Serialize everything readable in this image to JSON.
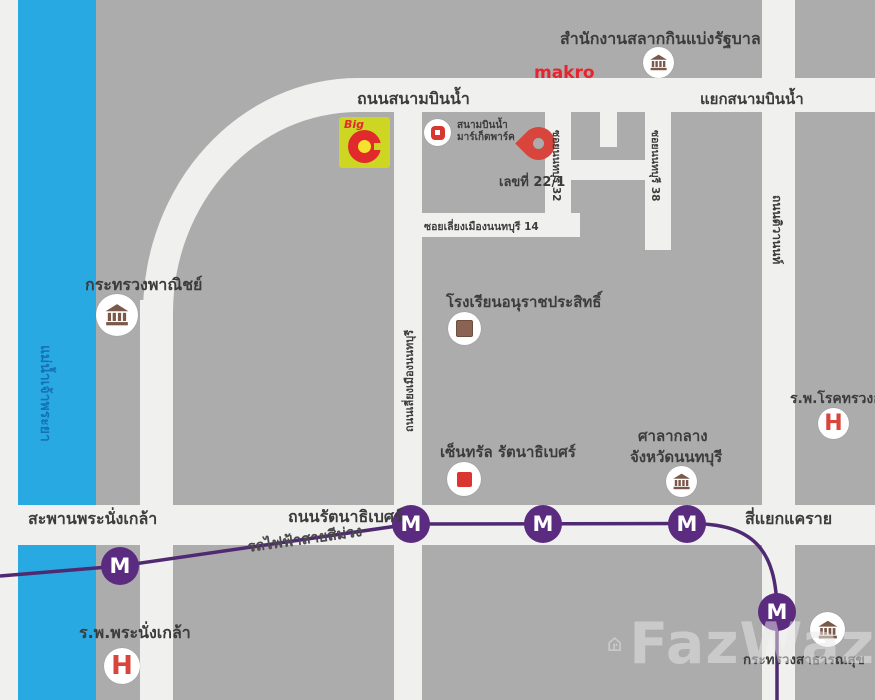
{
  "colors": {
    "block_gray": "#acacac",
    "road_white": "#f0f0ee",
    "river_blue": "#29a9e1",
    "river_text_blue": "#1573b5",
    "purple_line": "#4f2a72",
    "station_purple": "#5b2b80",
    "pin_red": "#d8453c",
    "makro_red": "#e8232d",
    "bigc_red": "#e02a2b",
    "bigc_yellow": "#cdd622",
    "icon_brown": "#7a594a",
    "label_text": "#3c3c3c"
  },
  "river": {
    "name": "แม่น้ำเจ้าพระยา"
  },
  "roads": {
    "sanambinnam": "ถนนสนามบินน้ำ",
    "sanambinnam_junction": "แยกสนามบินน้ำ",
    "liang_mueang": "ถนนเลี่ยงเมืองนนทบุรี",
    "soi_32": "ซอยนนทบุรี 32",
    "soi_38": "ซอยนนทบุรี 38",
    "soi_14": "ซอยเลี่ยงเมืองนนทบุรี 14",
    "rattanathibet": "ถนนรัตนาธิเบศร์",
    "tiwanon": "ถนนติวานนท์",
    "khae_rai_junction": "สี่แยกแคราย",
    "bridge": "สะพานพระนั่งเกล้า"
  },
  "transit": {
    "line_label": "รถไฟฟ้าสายสีม่วง",
    "station_letter": "M"
  },
  "places": {
    "lottery_office": "สำนักงานสลากกินแบ่งรัฐบาล",
    "makro": "makro",
    "bigc_word": "Big",
    "market_park_line1": "สนามบินน้ำ",
    "market_park_line2": "มาร์เก็ตพาร์ค",
    "pin_label": "เลขที่ 22/1",
    "commerce_ministry": "กระทรวงพาณิชย์",
    "school": "โรงเรียนอนุราชประสิทธิ์",
    "chest_hospital": "ร.พ.โรคทรวงอก",
    "central_rattanathibet": "เซ็นทรัล รัตนาธิเบศร์",
    "city_hall_line1": "ศาลากลาง",
    "city_hall_line2": "จังหวัดนนทบุรี",
    "pranangklao_hospital": "ร.พ.พระนั่งเกล้า",
    "health_ministry": "กระทรวงสาธารณสุข",
    "hospital_letter": "H"
  },
  "watermark": {
    "text": "FazWaz"
  }
}
